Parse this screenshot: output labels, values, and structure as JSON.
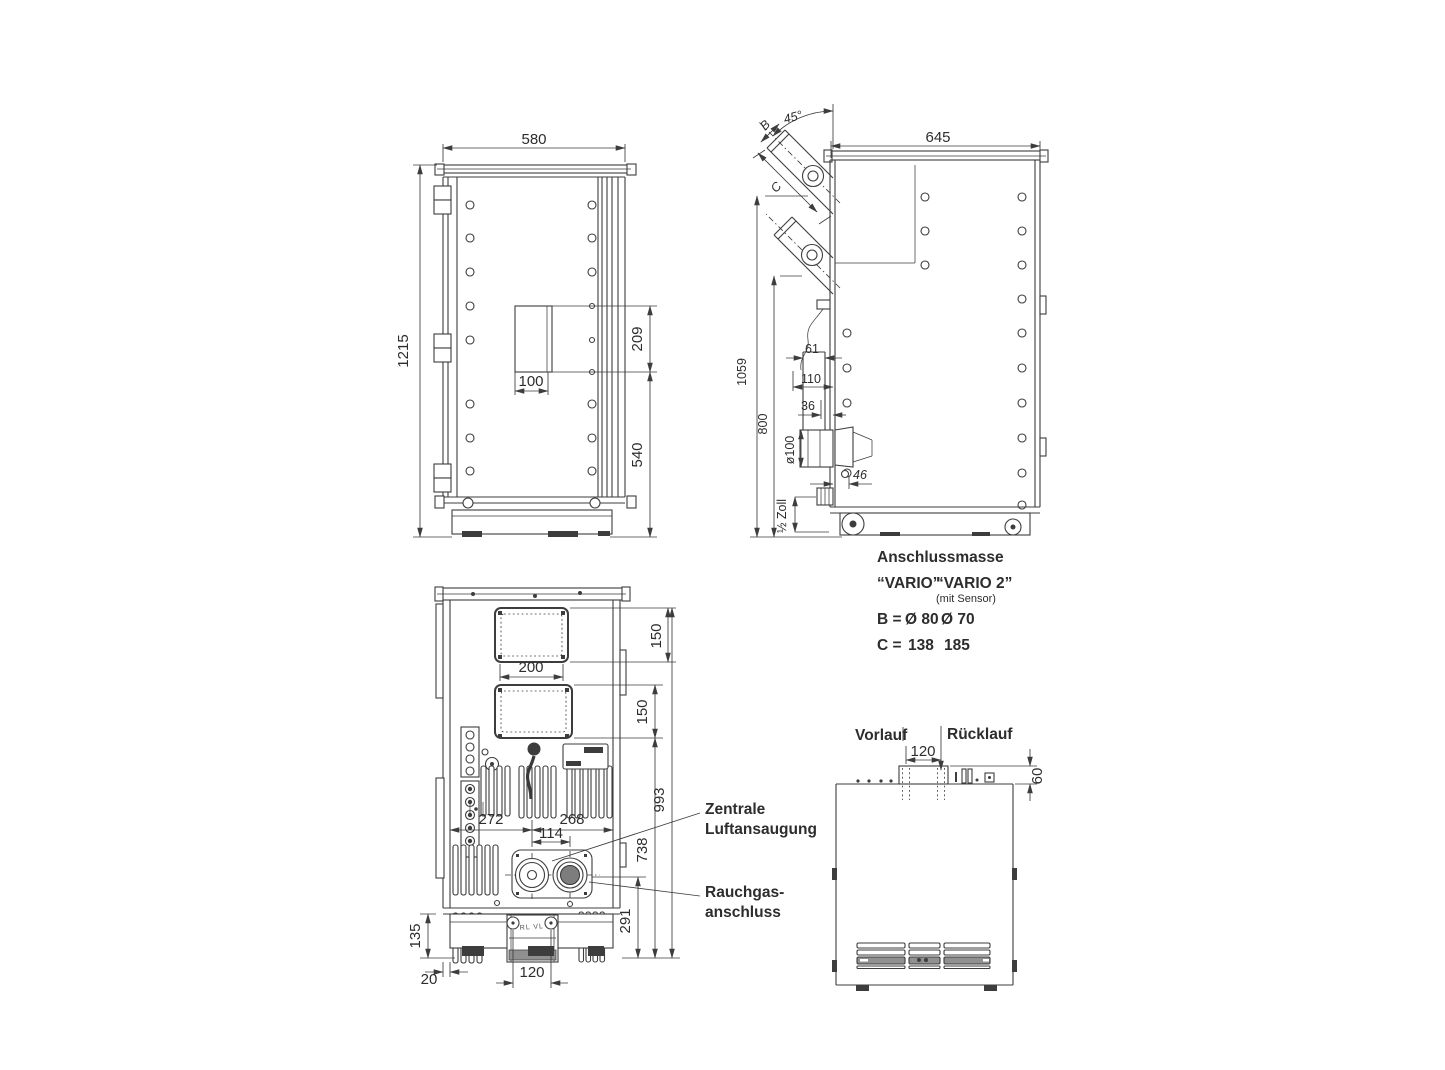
{
  "canvas": {
    "background": "#ffffff",
    "ink": "#3d3d3d"
  },
  "front_view": {
    "width": "580",
    "height": "1215",
    "opening_height": "209",
    "opening_width": "100",
    "lower_section_height": "540"
  },
  "side_view": {
    "flue_angle": "45°",
    "flue_dia_ref": "B",
    "flue_length_ref": "C",
    "depth": "645",
    "flue_axis_height": "1059",
    "stub_axis_height": "800",
    "hopper_offset": "61",
    "duct_offset": "110",
    "wall_offset": "36",
    "intake_dia": "ø100",
    "port_offset": "46",
    "fitting_size": "½ Zoll"
  },
  "connection_table": {
    "title": "Anschlussmasse",
    "model_1": "“VARIO”",
    "model_2": "“VARIO 2”",
    "model_2_note": "(mit Sensor)",
    "row_b_label": "B =",
    "row_b_value_1": "Ø 80",
    "row_b_value_2": "Ø 70",
    "row_c_label": "C =",
    "row_c_value_1": "138",
    "row_c_value_2": "185"
  },
  "rear_view": {
    "upper_opening_offset": "150",
    "opening_width": "200",
    "lower_opening_offset": "150",
    "left_port_span": "272",
    "port_spacing": "114",
    "right_port_span": "268",
    "height_993": "993",
    "height_738": "738",
    "height_291": "291",
    "base_height": "135",
    "rail_width": "20",
    "bracket_spacing": "120",
    "air_intake_label_line1": "Zentrale",
    "air_intake_label_line2": "Luftansaugung",
    "flue_label_line1": "Rauchgas-",
    "flue_label_line2": "anschluss",
    "bracket_marking": "RL VL"
  },
  "hydraulic_view": {
    "supply_label": "Vorlauf",
    "return_label": "Rücklauf",
    "pipe_spacing": "120",
    "connection_height": "60"
  }
}
